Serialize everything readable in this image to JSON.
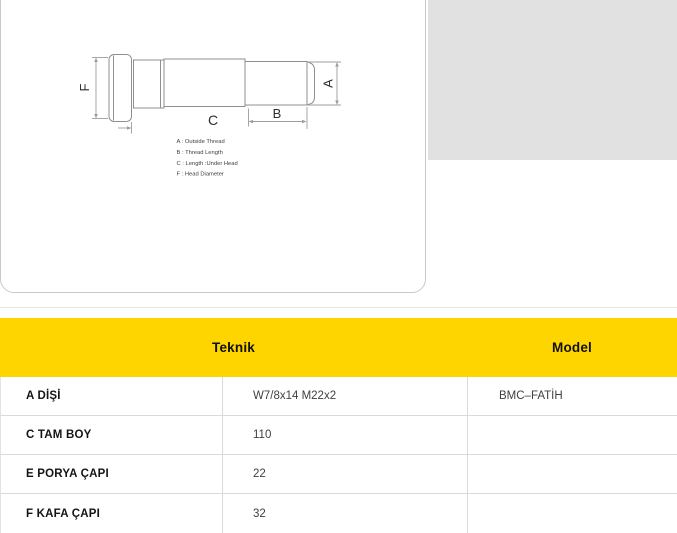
{
  "diagram": {
    "dim_labels": {
      "a": "A",
      "b": "B",
      "c": "C",
      "f": "F"
    },
    "legend": [
      "A : Outside Thread",
      "B : Thread Length",
      "C : Length :Under Head",
      "F : Head Diameter"
    ]
  },
  "spec_table": {
    "headers": {
      "teknik": "Teknik",
      "model": "Model"
    },
    "rows": [
      {
        "label": "A DİŞİ",
        "value": "W7/8x14 M22x2",
        "model": "BMC–FATİH"
      },
      {
        "label": "C TAM BOY",
        "value": "110",
        "model": ""
      },
      {
        "label": "E PORYA ÇAPI",
        "value": "22",
        "model": ""
      },
      {
        "label": "F KAFA ÇAPI",
        "value": "32",
        "model": ""
      }
    ]
  },
  "colors": {
    "accent_yellow": "#ffd500",
    "placeholder_gray": "#e1e1e1"
  }
}
